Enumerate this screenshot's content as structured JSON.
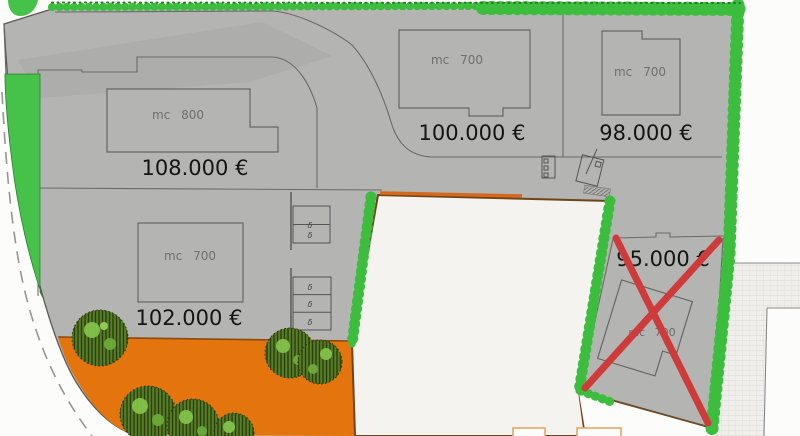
{
  "plan": {
    "type": "residential-site-plan",
    "lots": [
      {
        "id": "lot-1",
        "building_label": "mc 800",
        "price": "108.000 €",
        "crossed_out": false
      },
      {
        "id": "lot-2",
        "building_label": "mc 700",
        "price": "100.000 €",
        "crossed_out": false
      },
      {
        "id": "lot-3",
        "building_label": "mc 700",
        "price": "98.000 €",
        "crossed_out": false
      },
      {
        "id": "lot-4",
        "building_label": "mc 700",
        "price": "102.000 €",
        "crossed_out": false
      },
      {
        "id": "lot-5",
        "building_label": "mc 700",
        "price": "95.000 €",
        "crossed_out": true
      }
    ],
    "parking": {
      "stall_symbol": "δ",
      "group_1_stalls": 2,
      "group_2_stalls": 3
    },
    "colors": {
      "site_gray": "#b4b4b2",
      "hedge_green": "#3cbd3e",
      "wedge_green": "#46c24a",
      "ground_orange": "#e4740e",
      "excluded_lot_white": "#f4f3f0",
      "red_cross": "#ce3b3b",
      "boundary_brown": "#6e4418",
      "line_gray": "#6a6a6a"
    }
  }
}
